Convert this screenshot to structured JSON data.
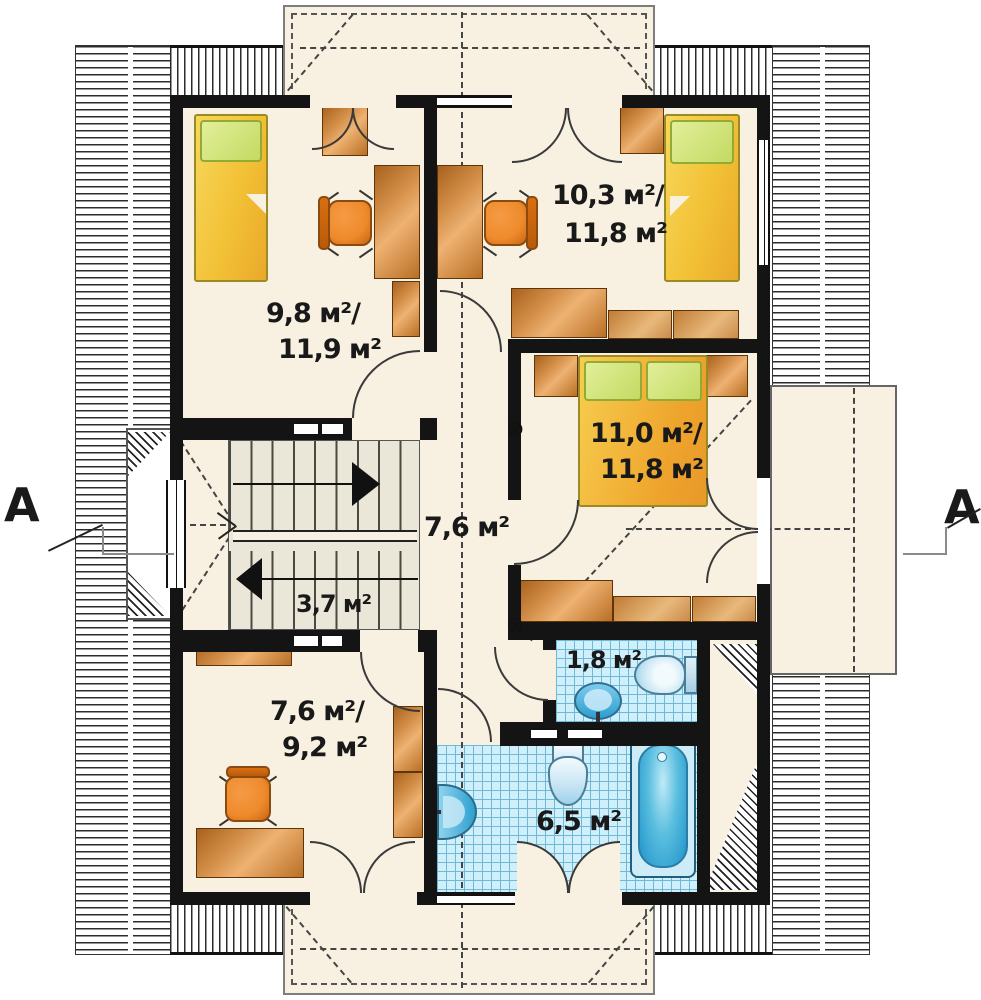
{
  "title": "attic floor plan",
  "rooms": {
    "bedroom_top_left": {
      "area_line1": "9,8 м²/",
      "area_line2": "11,9 м²"
    },
    "bedroom_top_right": {
      "area_line1": "10,3 м²/",
      "area_line2": "11,8 м²"
    },
    "bedroom_right": {
      "area_line1": "11,0 м²/",
      "area_line2": "11,8 м²"
    },
    "hall": {
      "area_line1": "7,6 м²"
    },
    "staircase": {
      "area_line1": "3,7 м²"
    },
    "study": {
      "area_line1": "7,6 м²/",
      "area_line2": "9,2 м²"
    },
    "wc": {
      "area_line1": "1,8 м²"
    },
    "bathroom": {
      "area_line1": "6,5 м²"
    }
  },
  "section_marks": {
    "left": "A",
    "right": "A"
  },
  "symbols": {
    "vent": "⊗"
  },
  "fixtures": [
    "single-bed",
    "double-bed",
    "pillow",
    "nightstand",
    "desk",
    "office-chair",
    "wardrobe",
    "sofa",
    "shelf",
    "cabinet",
    "staircase",
    "direction-arrow",
    "toilet",
    "washbasin",
    "pedestal-sink",
    "bathtub",
    "balcony",
    "roof-hatch",
    "ridge-line",
    "window",
    "door",
    "section-line"
  ],
  "colors": {
    "floor": "#f8f1e1",
    "wall": "#141414",
    "wood": "#cf8a43",
    "wood_light": "#e8b97c",
    "bed_yellow": "#f2c135",
    "bed_orange": "#eea42c",
    "pillow_green": "#c3da62",
    "chair_orange": "#ee8a2b",
    "tile_blue": "#cfeffa",
    "tile_line": "#6fb9d6",
    "fixture_blue": "#2d9fd0",
    "tub_blue": "#1f93cc",
    "stair_bg": "#ebe7d8",
    "dash": "#444444",
    "hatch": "#2b2b2b"
  }
}
